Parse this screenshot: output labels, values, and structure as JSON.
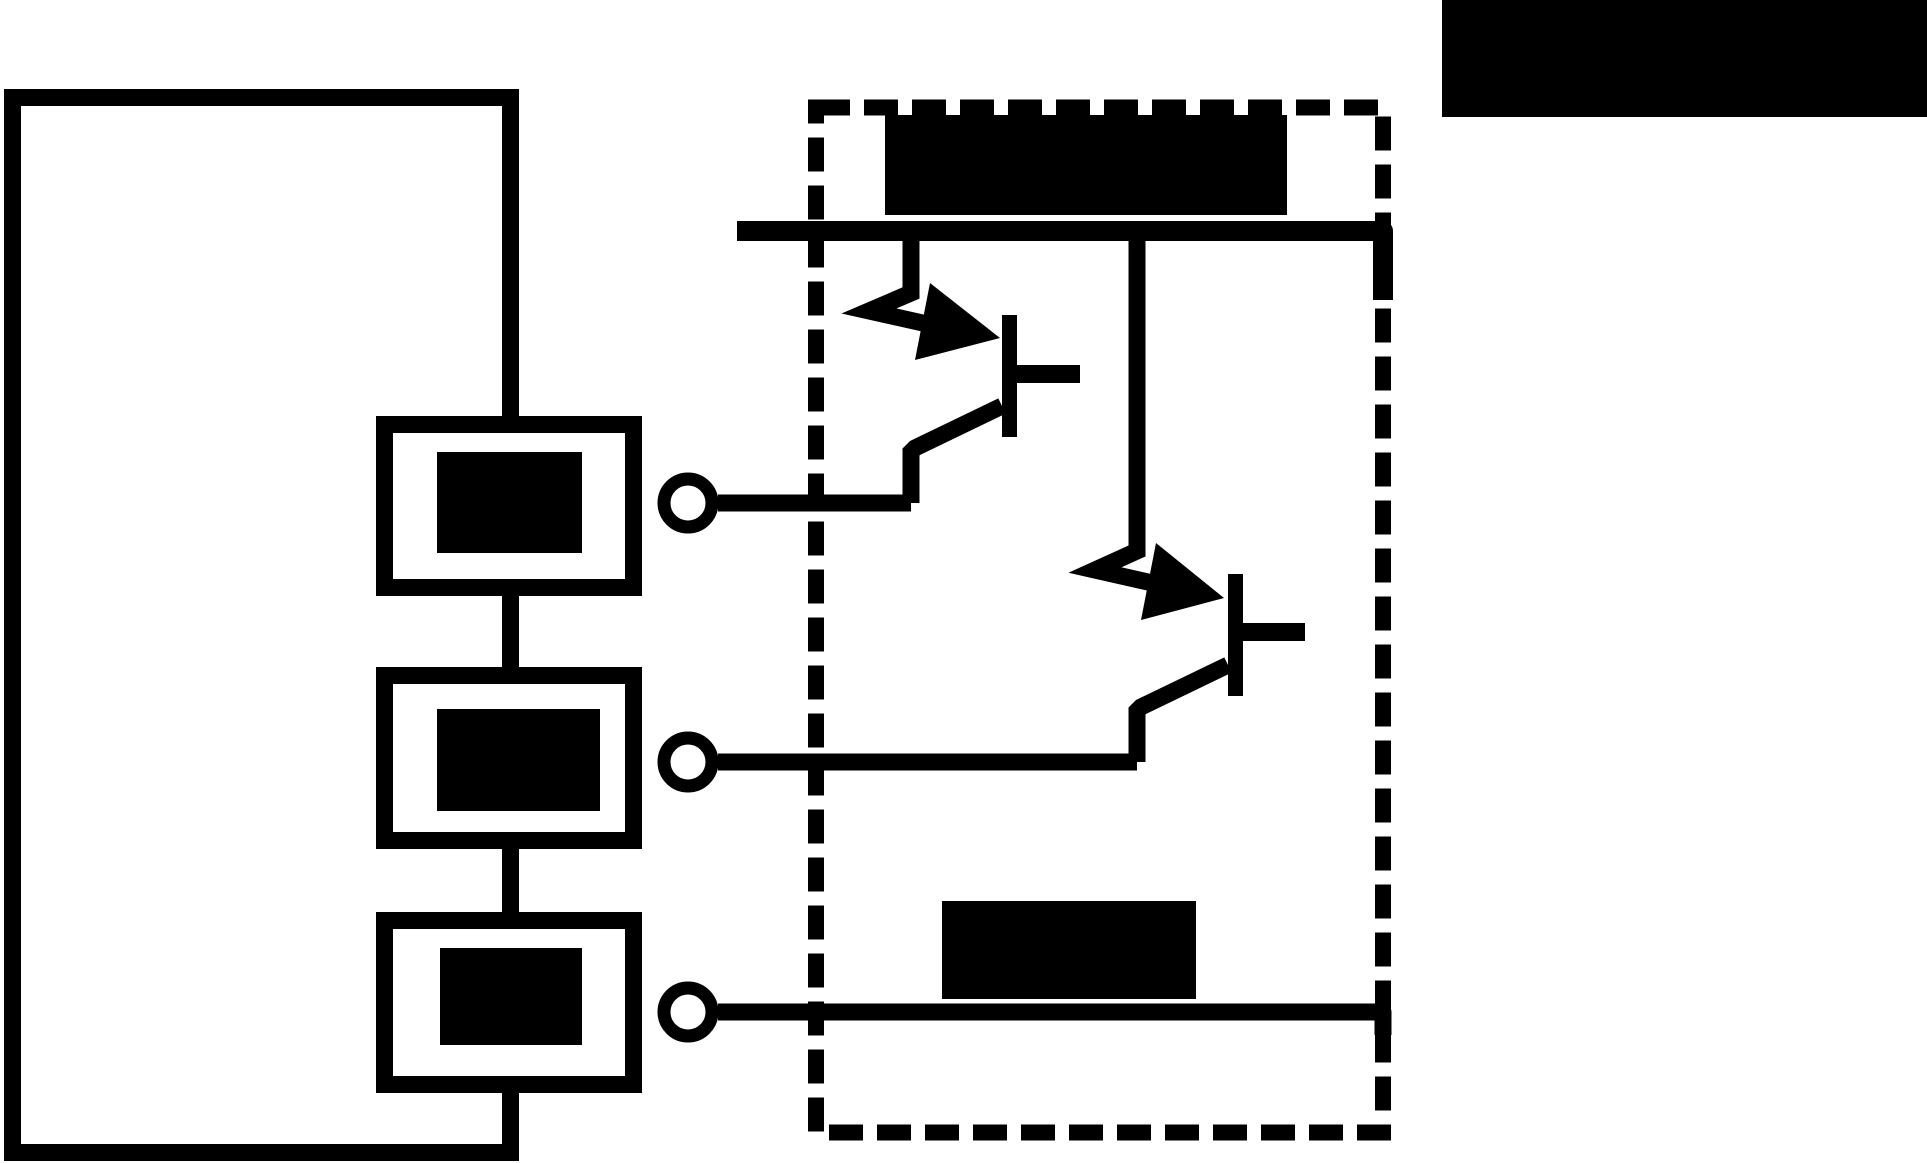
{
  "colors": {
    "ink": "#000000",
    "paper": "#ffffff"
  },
  "canvas": {
    "width": "1927",
    "height": "1163",
    "viewbox": "0 0 1927 1163"
  },
  "diagram": {
    "type": "circuit-schematic",
    "style": "monochrome line art; all textual labels are redacted with solid black bars",
    "regions": {
      "left_loop": "closed wiring loop containing three series component boxes with blacked-out labels",
      "dashed_enclosure": "dashed-outline module with a top supply rail feeding two PNP-style transistors and a bottom return line",
      "terminals": "three open-circle terminals connecting the loop components into the dashed module"
    },
    "component_counts": {
      "component_boxes": 3,
      "terminals": 3,
      "transistors": 2,
      "redacted_labels": 6
    },
    "redacted_labels": [
      {
        "id": "corner-label",
        "location": "top-right corner of image"
      },
      {
        "id": "rail-label",
        "location": "above top supply rail inside dashed enclosure"
      },
      {
        "id": "bottom-label",
        "location": "above bottom return line inside dashed enclosure"
      },
      {
        "id": "box1-label",
        "location": "inside component box 1"
      },
      {
        "id": "box2-label",
        "location": "inside component box 2"
      },
      {
        "id": "box3-label",
        "location": "inside component box 3"
      }
    ],
    "transistor_symbols": [
      {
        "id": "transistor-upper",
        "style": "pnp-arrow-into-bar",
        "fed_from": "top-rail",
        "output": "terminal-1-line"
      },
      {
        "id": "transistor-lower",
        "style": "pnp-arrow-into-bar",
        "fed_from": "top-rail",
        "output": "terminal-2-line"
      }
    ]
  }
}
